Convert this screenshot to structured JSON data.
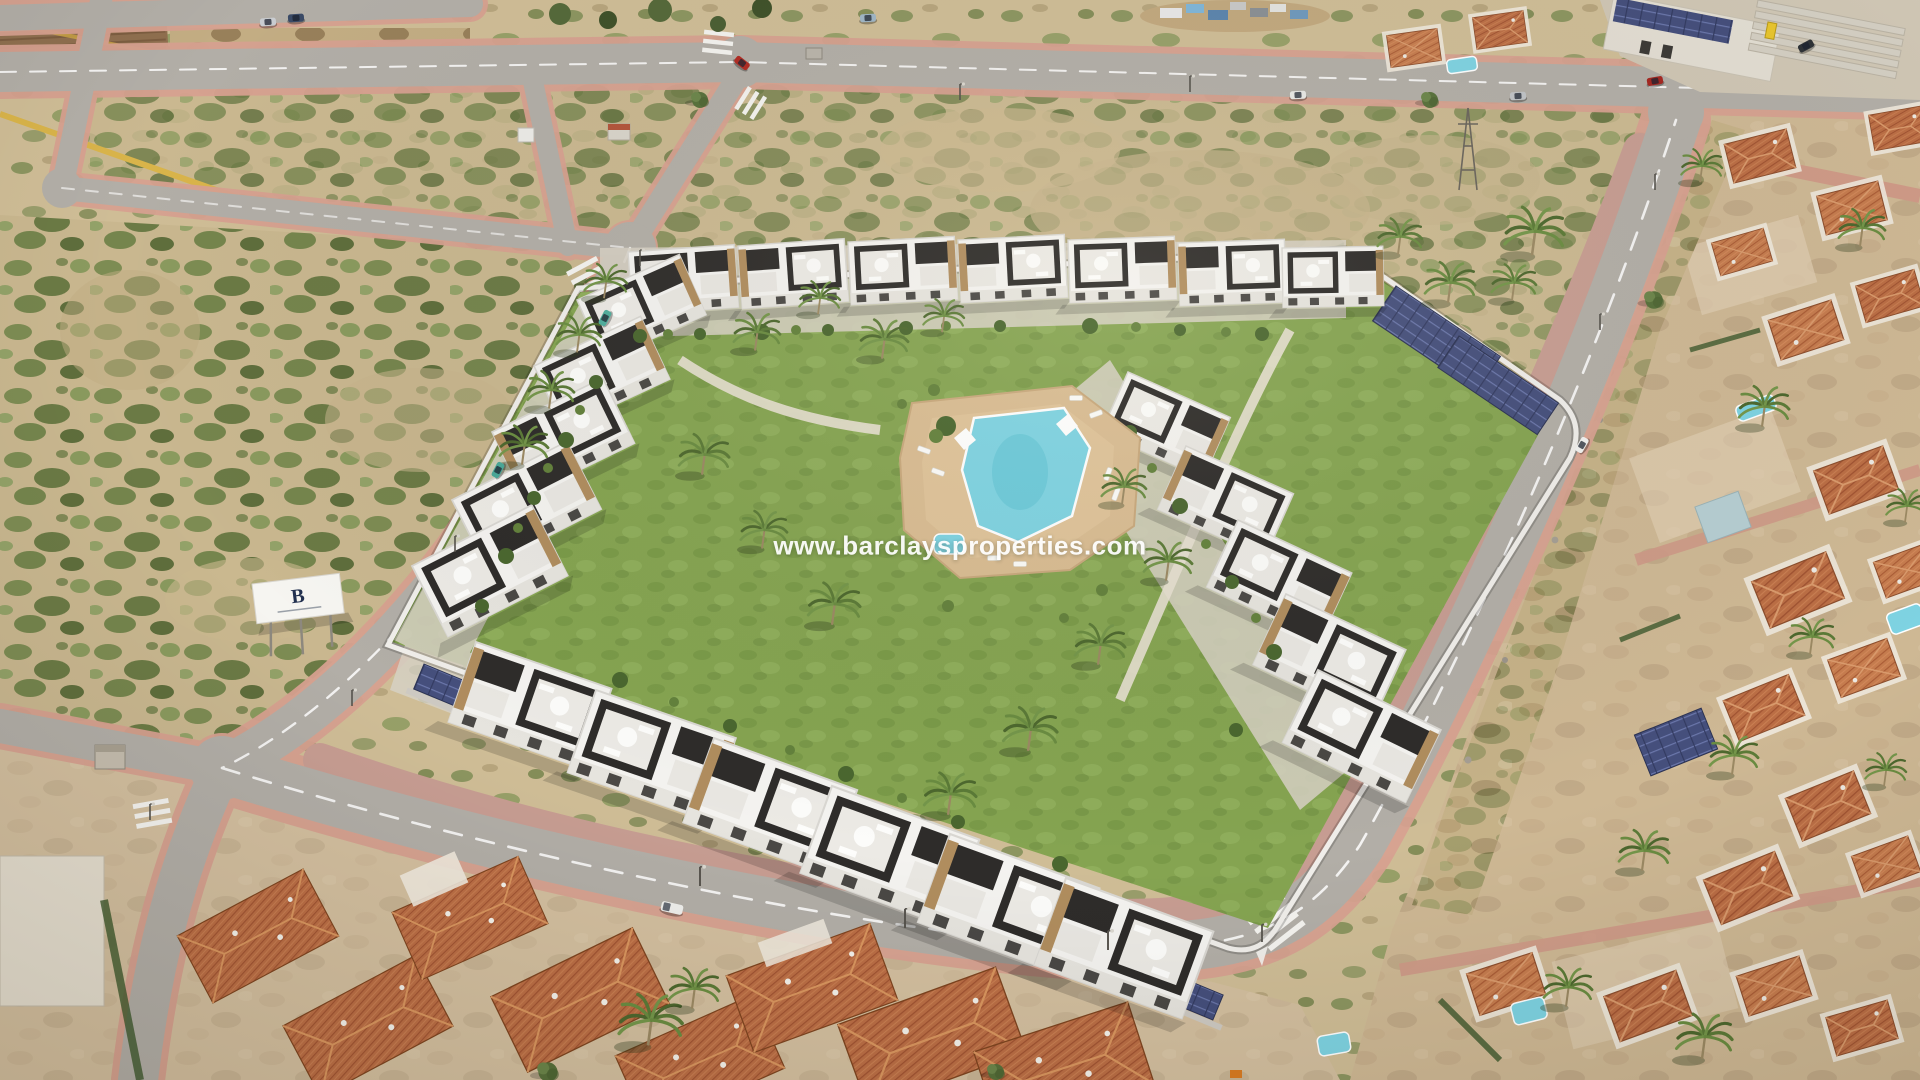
{
  "watermark": {
    "text": "www.barclaysproperties.com"
  },
  "billboard": {
    "logo_letter": "B"
  },
  "palette": {
    "sand": "#cbb893",
    "road": "#b2aea7",
    "sidewalk": "#d7a190",
    "lawn": "#83a24f",
    "pool": "#7ed3e2",
    "deck": "#d9bc92",
    "house_white": "#f4f3f0",
    "house_dark": "#2e2c2a",
    "stone": "#b08d5e",
    "solar": "#46517d",
    "terracotta": "#b76b42",
    "wall": "#f0eeea",
    "watermark_color": "#ffffff"
  }
}
